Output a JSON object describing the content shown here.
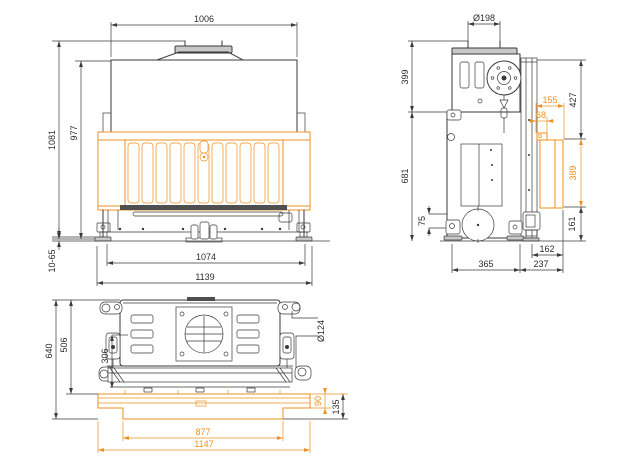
{
  "meta": {
    "background_color": "#ffffff",
    "line_color": "#3a3a3a",
    "accent_color": "#ee9121",
    "drawing_subject": "fireplace-insert-three-view-dimension-drawing"
  },
  "front_view": {
    "dims": {
      "top_width": "1006",
      "overall_height": "1081",
      "body_height": "977",
      "leg_range": "10-65",
      "base_width": "1074",
      "frame_width": "1139"
    }
  },
  "side_view": {
    "dims": {
      "flue_diameter": "Ø198",
      "upper_height": "399",
      "upper_front_height": "427",
      "door_depth": "155",
      "door_lip_depth": "68",
      "glass_height": "389",
      "lower_front_height": "161",
      "body_height": "681",
      "foot_height": "75",
      "rear_inset_depth": "162",
      "base_depth": "365",
      "front_depth": "237"
    }
  },
  "plan_view": {
    "dims": {
      "overall_depth": "640",
      "body_depth": "506",
      "latch_depth": "306",
      "spigot_diameter": "Ø124",
      "frame_band_depth": "90",
      "frame_depth": "135",
      "opening_width": "877",
      "frame_overall_width": "1147"
    }
  }
}
